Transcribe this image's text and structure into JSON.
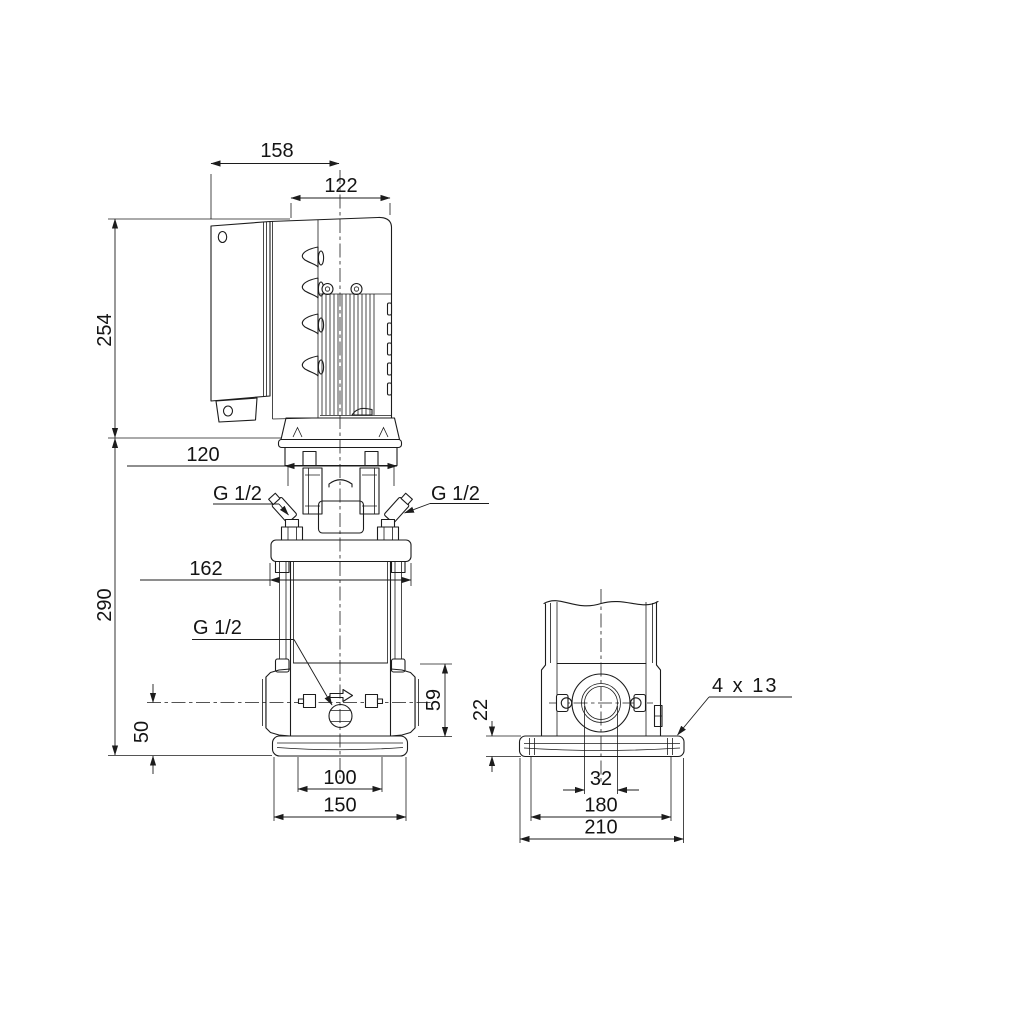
{
  "front_view": {
    "dims": {
      "total_depth": "158",
      "motor_diameter": "122",
      "motor_height": "254",
      "motor_stool_width": "120",
      "pump_height": "290",
      "head_width": "162",
      "port_section_height": "59",
      "port_centerline_height": "50",
      "base_inner_width": "100",
      "base_outer_width": "150"
    },
    "ports": {
      "vent_left": "G 1/2",
      "vent_right": "G 1/2",
      "drain": "G 1/2"
    }
  },
  "side_view": {
    "dims": {
      "base_plate_thickness": "22",
      "port_bore": "32",
      "bolt_hole_spacing": "180",
      "base_plate_depth": "210"
    },
    "bolt_holes_note": "4 x 13"
  },
  "colors": {
    "line": "#1c1c1c",
    "background": "#ffffff"
  }
}
